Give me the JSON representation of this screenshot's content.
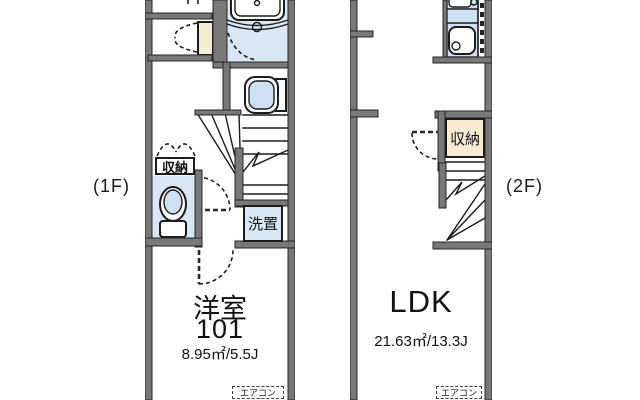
{
  "title": "apartment-two-story-floor-plan",
  "floor1": {
    "floor_label": "(1F)",
    "room_name": "洋室",
    "room_number": "101",
    "room_area": "8.95㎡/5.5J",
    "closet_label": "収納",
    "laundry_label": "洗置",
    "aircon_label": "エアコン",
    "fixture_icons": [
      "bathtub-icon",
      "washbasin-icon",
      "toilet-icon",
      "staircase-icon",
      "door-swing-arc",
      "folding-door-dashes"
    ]
  },
  "floor2": {
    "floor_label": "(2F)",
    "room_name": "LDK",
    "room_area": "21.63㎡/13.3J",
    "closet_label": "収納",
    "aircon_label": "エアコン",
    "fixture_icons": [
      "kitchen-stove-icon",
      "kitchen-sink-icon",
      "duct-space-dashes",
      "staircase-icon",
      "door-swing-arc"
    ]
  },
  "colors": {
    "background": "#ffffff",
    "wall": "#787878",
    "outline": "#1c1c1c",
    "wet_area_floor": "#d9e6f4",
    "fixture_fill": "#cfe0f2",
    "closet_fill": "#f7ecd3"
  }
}
